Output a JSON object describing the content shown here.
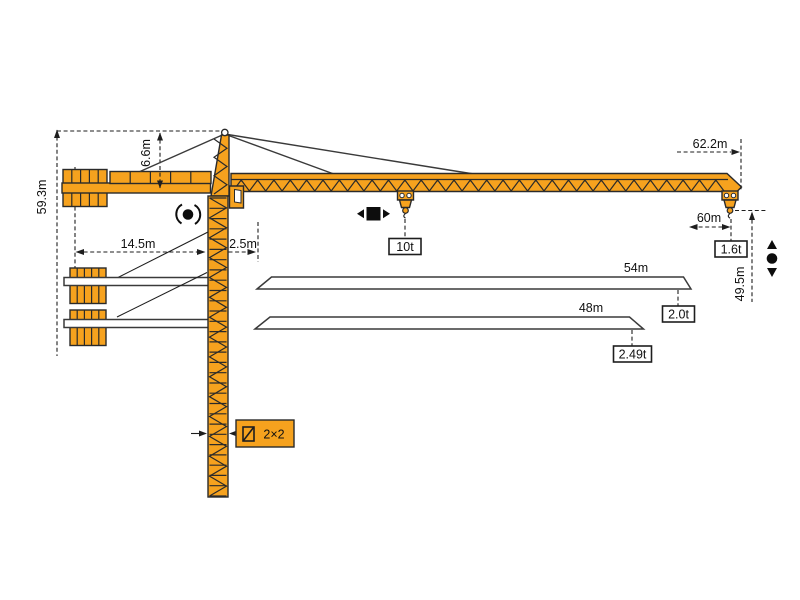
{
  "diagram": {
    "type": "tower-crane-specification-diagram",
    "dimensions": {
      "total_height": "59.3m",
      "tower_head_height": "6.6m",
      "counter_jib_length": "14.5m",
      "min_radius": "2.5m",
      "max_radius": "62.2m",
      "radius_60m": "60m",
      "hook_height": "49.5m"
    },
    "jib_options": [
      {
        "length": "54m",
        "tip_load": "2.0t"
      },
      {
        "length": "48m",
        "tip_load": "2.49t"
      }
    ],
    "loads": {
      "max_load": "10t",
      "tip_load_max_radius": "1.6t"
    },
    "mast": {
      "section_size": "2×2"
    },
    "icons": {
      "slewing": "slewing-rotation-icon",
      "trolley": "trolley-travel-icon",
      "hoist": "hoist-up-down-icon",
      "mast_section": "mast-section-icon"
    },
    "colors": {
      "crane_orange": "#F6A21E",
      "outline": "#2A2A2A",
      "background": "#FFFFFF"
    }
  }
}
